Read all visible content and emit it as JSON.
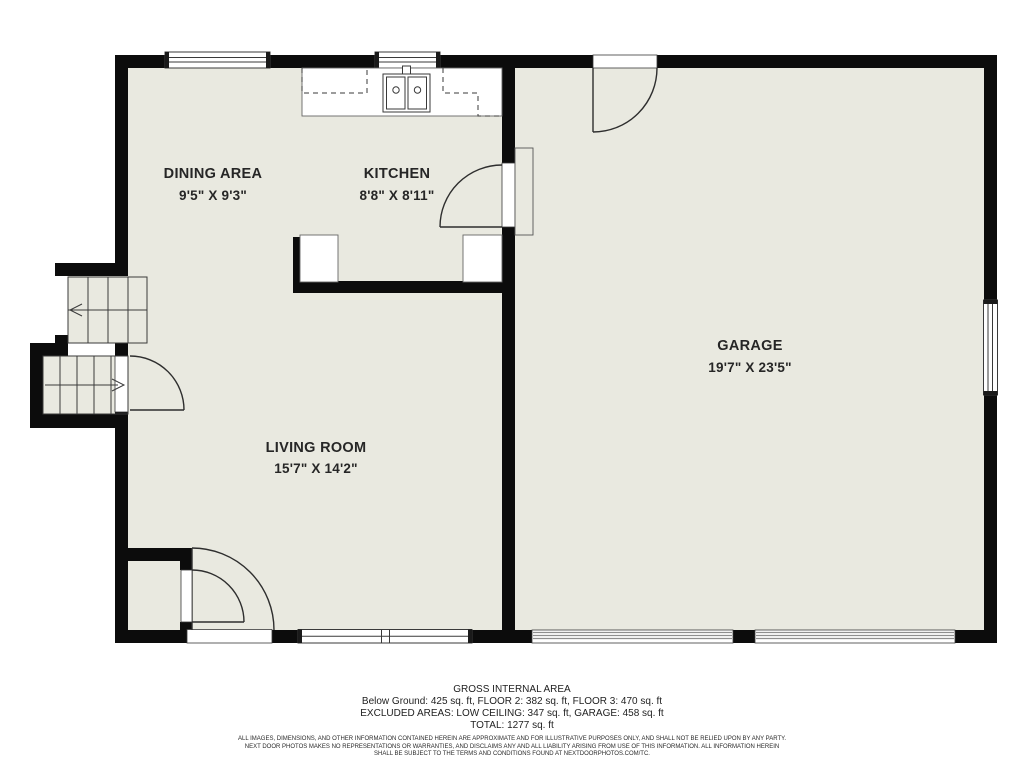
{
  "colors": {
    "floor": "#e9e9e0",
    "wall": "#0c0c0c",
    "outline": "#3a3a3a",
    "text": "#262626"
  },
  "rooms": [
    {
      "id": "dining",
      "label": "DINING AREA",
      "dims": "9'5\" X 9'3\""
    },
    {
      "id": "kitchen",
      "label": "KITCHEN",
      "dims": "8'8\" X 8'11\""
    },
    {
      "id": "garage",
      "label": "GARAGE",
      "dims": "19'7\" X 23'5\""
    },
    {
      "id": "living",
      "label": "LIVING ROOM",
      "dims": "15'7\" X 14'2\""
    }
  ],
  "footer": {
    "title": "GROSS INTERNAL AREA",
    "areas_line": "Below Ground: 425 sq. ft, FLOOR 2: 382 sq. ft, FLOOR 3: 470 sq. ft",
    "excluded_line": "EXCLUDED AREAS: LOW CEILING: 347 sq. ft, GARAGE: 458 sq. ft",
    "total_line": "TOTAL: 1277 sq. ft"
  },
  "disclaimer": {
    "line1": "ALL IMAGES, DIMENSIONS, AND OTHER INFORMATION CONTAINED HEREIN ARE APPROXIMATE AND FOR ILLUSTRATIVE PURPOSES ONLY, AND SHALL NOT BE RELIED UPON BY ANY PARTY.",
    "line2": "NEXT DOOR PHOTOS MAKES NO REPRESENTATIONS OR WARRANTIES, AND DISCLAIMS ANY AND ALL LIABILITY ARISING FROM USE OF THIS INFORMATION. ALL INFORMATION HEREIN",
    "line3": "SHALL BE SUBJECT TO THE TERMS AND CONDITIONS FOUND AT NEXTDOORPHOTOS.COM/TC."
  }
}
